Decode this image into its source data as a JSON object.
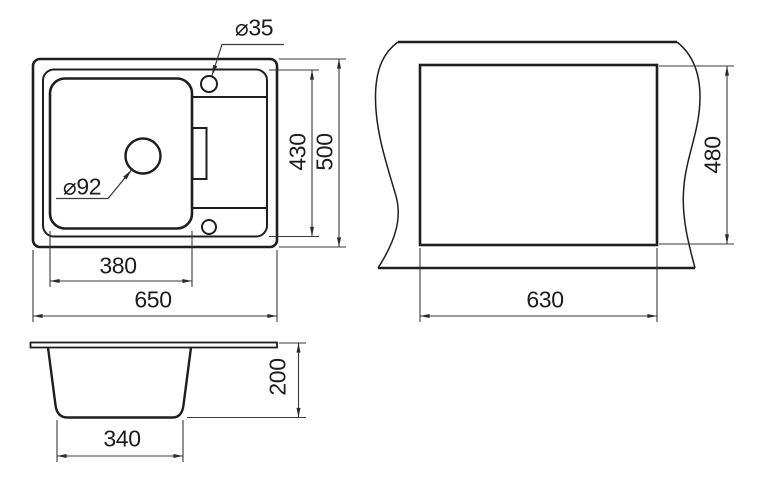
{
  "colors": {
    "background": "#ffffff",
    "object_line": "#1e1e1e",
    "dimension_line": "#3a3a3a",
    "text": "#1c1c1c"
  },
  "views": {
    "top": {
      "name": "sink top view",
      "dims": {
        "faucet_hole_diameter": "⌀35",
        "drain_hole_diameter": "⌀92",
        "bowl_width": "380",
        "overall_width": "650",
        "inner_length": "430",
        "overall_length": "500"
      }
    },
    "cutout": {
      "name": "countertop cutout view",
      "dims": {
        "cutout_width": "630",
        "cutout_length": "480"
      }
    },
    "side": {
      "name": "sink side section view",
      "dims": {
        "bowl_bottom_width": "340",
        "bowl_depth": "200"
      }
    }
  }
}
